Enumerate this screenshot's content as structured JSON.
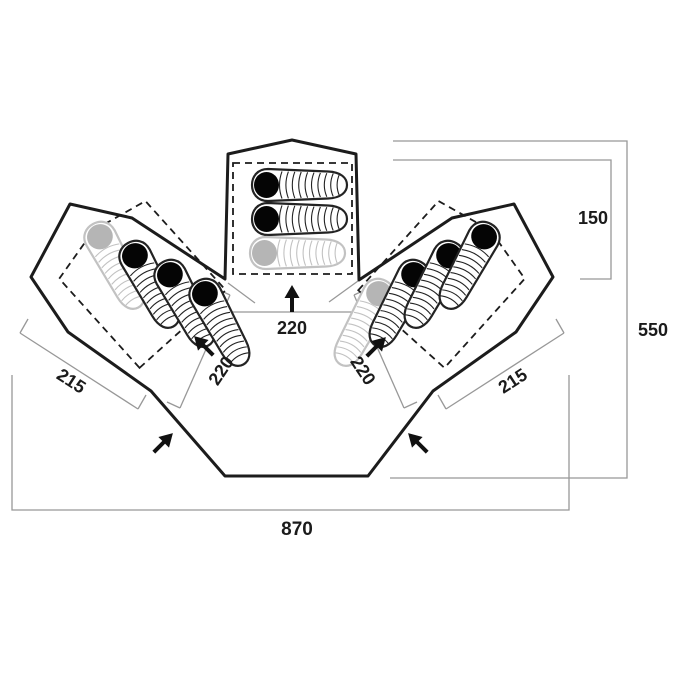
{
  "page": {
    "title": "Tent floorplan top view diagram",
    "background": "#ffffff"
  },
  "diagram": {
    "type": "tent-floorplan-top-view",
    "labels": {
      "center_pod_width": "220",
      "left_pod_entrance": "220",
      "right_pod_entrance": "220",
      "left_pod_width": "215",
      "right_pod_width": "215",
      "center_pod_depth": "150",
      "overall_depth": "550",
      "overall_width": "870"
    },
    "colors": {
      "outline": "#1c1c1c",
      "dashed_inner": "#1c1c1c",
      "dimension_lines": "#989898",
      "dimension_text": "#1b1b1b",
      "bag_dark": "#232323",
      "bag_faded": "#c2c2c2",
      "bag_hood": "#050505"
    },
    "sleeping_bags": {
      "center_pod": 3,
      "left_pod": 4,
      "right_pod": 4,
      "total": 11,
      "faded_per_pod": 1
    },
    "arrows": [
      "center-pod-entrance-arrow",
      "left-pod-entrance-arrow",
      "right-pod-entrance-arrow",
      "porch-left-door-arrow",
      "porch-right-door-arrow"
    ]
  }
}
